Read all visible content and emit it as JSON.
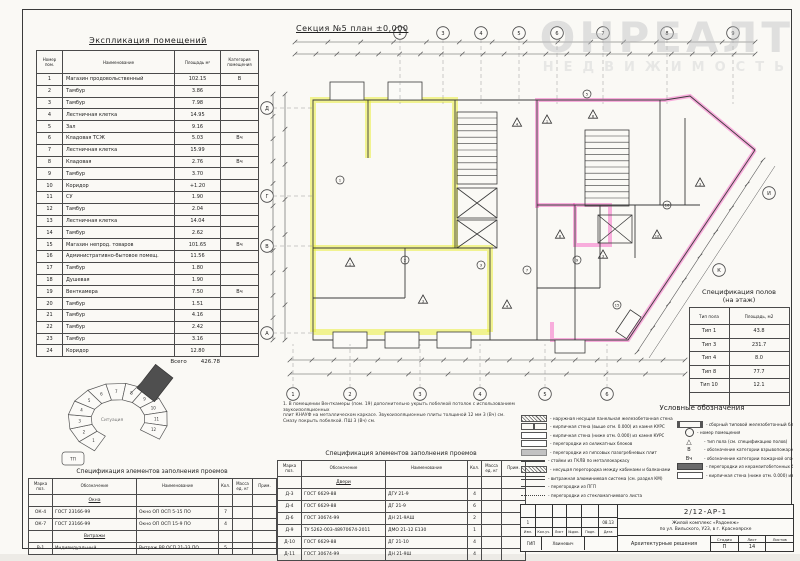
{
  "watermark": {
    "line1": "ОНРЕАЛТ",
    "line2": "НЕДВИЖИМОСТЬ"
  },
  "plan": {
    "title": "Секция №5 план ±0,000",
    "top_bubbles": [
      "2",
      "3",
      "4",
      "5",
      "6",
      "7",
      "8",
      "9"
    ],
    "left_bubbles": [
      "Д",
      "Г",
      "В",
      "А"
    ],
    "bottom_bubbles": [
      "1",
      "2",
      "3",
      "4",
      "5",
      "6"
    ],
    "diag_bubbles": [
      "И",
      "К"
    ],
    "triangles": [
      "1",
      "3",
      "4",
      "8",
      "3",
      "10",
      "4",
      "1",
      "8",
      "3"
    ],
    "circles": [
      "1",
      "2",
      "3",
      "7",
      "9",
      "15",
      "16",
      "5"
    ]
  },
  "explication": {
    "title": "Экспликация помещений",
    "headers": [
      "Номер пом.",
      "Наименование",
      "Площадь м²",
      "Категория помещения"
    ],
    "rows": [
      [
        "1",
        "Магазин продовольственный",
        "102.15",
        "В"
      ],
      [
        "2",
        "Тамбур",
        "3.86",
        ""
      ],
      [
        "3",
        "Тамбур",
        "7.98",
        ""
      ],
      [
        "4",
        "Лестничная клетка",
        "14.95",
        ""
      ],
      [
        "5",
        "Зал",
        "9.16",
        ""
      ],
      [
        "6",
        "Кладовая ТСЖ",
        "5.03",
        "Вч"
      ],
      [
        "7",
        "Лестничная клетка",
        "15.99",
        ""
      ],
      [
        "8",
        "Кладовая",
        "2.76",
        "Вч"
      ],
      [
        "9",
        "Тамбур",
        "3.70",
        ""
      ],
      [
        "10",
        "Коридор",
        "+1.20",
        ""
      ],
      [
        "11",
        "СУ",
        "1.90",
        ""
      ],
      [
        "12",
        "Тамбур",
        "2.04",
        ""
      ],
      [
        "13",
        "Лестничная клетка",
        "14.04",
        ""
      ],
      [
        "14",
        "Тамбур",
        "2.62",
        ""
      ],
      [
        "15",
        "Магазин непрод. товаров",
        "101.65",
        "Вч"
      ],
      [
        "16",
        "Административно-бытовое помещ.",
        "11.56",
        ""
      ],
      [
        "17",
        "Тамбур",
        "1.80",
        ""
      ],
      [
        "18",
        "Душевая",
        "1.90",
        ""
      ],
      [
        "19",
        "Венткамера",
        "7.50",
        "Вч"
      ],
      [
        "20",
        "Тамбур",
        "1.51",
        ""
      ],
      [
        "21",
        "Тамбур",
        "4.16",
        ""
      ],
      [
        "22",
        "Тамбур",
        "2.42",
        ""
      ],
      [
        "23",
        "Тамбур",
        "3.16",
        ""
      ],
      [
        "24",
        "Коридор",
        "12.80",
        ""
      ]
    ],
    "total_label": "Всего",
    "total": "426.78"
  },
  "floors": {
    "title1": "Спецификация полов",
    "title2": "(на этаж)",
    "headers": [
      "Тип пола",
      "Площадь, м2"
    ],
    "rows": [
      [
        "Тип 1",
        "43.8"
      ],
      [
        "Тип 3",
        "231.7"
      ],
      [
        "Тип 4",
        "8.0"
      ],
      [
        "Тип 8",
        "77.7"
      ],
      [
        "Тип 10",
        "12.1"
      ],
      [
        "",
        ""
      ]
    ]
  },
  "openings_windows": {
    "title": "Спецификация элементов заполнения проемов",
    "headers": [
      "Марка поз.",
      "Обозначение",
      "Наименование",
      "Кол.",
      "Масса ед. кг",
      "Прим."
    ],
    "groups": [
      {
        "name": "Окна",
        "rows": [
          [
            "ОК-4",
            "ГОСТ 23166-99",
            "Окно ОП ОСП 5-15 ПО",
            "7",
            "",
            ""
          ],
          [
            "ОК-7",
            "ГОСТ 23166-99",
            "Окно ОП ОСП 15-9 ПО",
            "4",
            "",
            ""
          ]
        ]
      },
      {
        "name": "Витражи",
        "rows": [
          [
            "В-1",
            "Индивидуальный",
            "Витраж ВР ОСП 21-33 ПО",
            "5",
            "",
            ""
          ]
        ]
      }
    ]
  },
  "openings_doors": {
    "title": "Спецификация элементов заполнения проемов",
    "headers": [
      "Марка поз.",
      "Обозначение",
      "Наименование",
      "Кол.",
      "Масса ед. кг",
      "Прим."
    ],
    "groups": [
      {
        "name": "Двери",
        "rows": [
          [
            "Д-3",
            "ГОСТ 6629-88",
            "ДГУ 21-9",
            "4",
            "",
            ""
          ],
          [
            "Д-4",
            "ГОСТ 6629-88",
            "ДГ 21-9",
            "6",
            "",
            ""
          ],
          [
            "Д-6",
            "ГОСТ 30674-99",
            "ДН 21-9АШ",
            "2",
            "",
            ""
          ],
          [
            "Д-9",
            "ТУ 5262-003-48970674-2011",
            "ДМО 21-12 Е130",
            "1",
            "",
            ""
          ],
          [
            "Д-10",
            "ГОСТ 6629-88",
            "ДГ 21-10",
            "4",
            "",
            ""
          ],
          [
            "Д-11",
            "ГОСТ 30674-99",
            "ДН 21-9Ш",
            "4",
            "",
            ""
          ]
        ]
      }
    ]
  },
  "notes": [
    "1. В помещении Венткамеры (пом. 19) дополнительно укрыть побелкой потолок с использованием звукоизоляционных",
    "плит КНАУФ на металлическом каркасе. Звукоизоляционные плиты толщиной 12 мм 3 (Вч) см.",
    "Смазу покрыть побелкой. ПШ 3 (Вч) см."
  ],
  "legend": {
    "title": "Условные обозначения",
    "left": [
      {
        "sym": "hatch",
        "text": "наружная несущая панельная железобетонная стена"
      },
      {
        "sym": "brick2",
        "text": "кирпичная стена (выше отм. 0.000) из камня КУРС"
      },
      {
        "sym": "outline",
        "text": "кирпичная стена (ниже отм. 0.000) из камня КУРС"
      },
      {
        "sym": "outline",
        "text": "перегородки из силикатных блоков"
      },
      {
        "sym": "gray",
        "text": "перегородки из гипсовых пазогребневых плит"
      },
      {
        "sym": "thick",
        "text": "стойки из ГКЛВ по металлокаркасу"
      },
      {
        "sym": "hatch",
        "text": "несущая перегородка между кабинами и балконами"
      },
      {
        "sym": "dline",
        "text": "витражная алюминиевая система (см. раздел КМ)"
      },
      {
        "sym": "thin",
        "text": "перегородки из ПГП"
      },
      {
        "sym": "dot",
        "text": "перегородки из стекломагниевого листа"
      }
    ],
    "right": [
      {
        "sym": "block",
        "text": "сборный типовой железобетонный блок"
      },
      {
        "sym": "circle",
        "text": "номер помещения"
      },
      {
        "sym": "tri",
        "text": "тип пола (см. спецификацию полов)"
      },
      {
        "sym": "txtB",
        "text": "обозначение категории взрывопожарной опасности"
      },
      {
        "sym": "txtBch",
        "text": "обозначение категории пожарной опасности"
      },
      {
        "sym": "solid",
        "text": "перегородки из керамзитобетонных блоков"
      },
      {
        "sym": "outline",
        "text": "кирпичная стена (ниже отм. 0.000) из камня КУРС"
      }
    ]
  },
  "site": {
    "center_label": "Ситуация",
    "segments": [
      "1",
      "2",
      "3",
      "4",
      "5",
      "6",
      "7",
      "8",
      "9",
      "10",
      "11",
      "12"
    ],
    "box_label": "ТП"
  },
  "titleblock": {
    "doc_number": "2/12-АР-1",
    "project_line1": "Жилой комплекс «Радонеж»",
    "project_line2": "по ул. Вильского, У23, в г. Красноярске",
    "sheet_name": "Архитектурные решения",
    "stage_label": "Стадия",
    "sheet_label": "Лист",
    "sheets_label": "Листов",
    "stage_value": "П",
    "sheet_value": "14",
    "sheets_value": "",
    "left_header_cells": [
      "Изм.",
      "Кол.уч.",
      "Лист",
      "№док.",
      "Подп.",
      "Дата"
    ],
    "left_value_cells": [
      "1",
      "",
      "",
      "",
      "",
      "08.13"
    ],
    "gip_cells": [
      "ГИП",
      "Хвиневич",
      ""
    ]
  }
}
